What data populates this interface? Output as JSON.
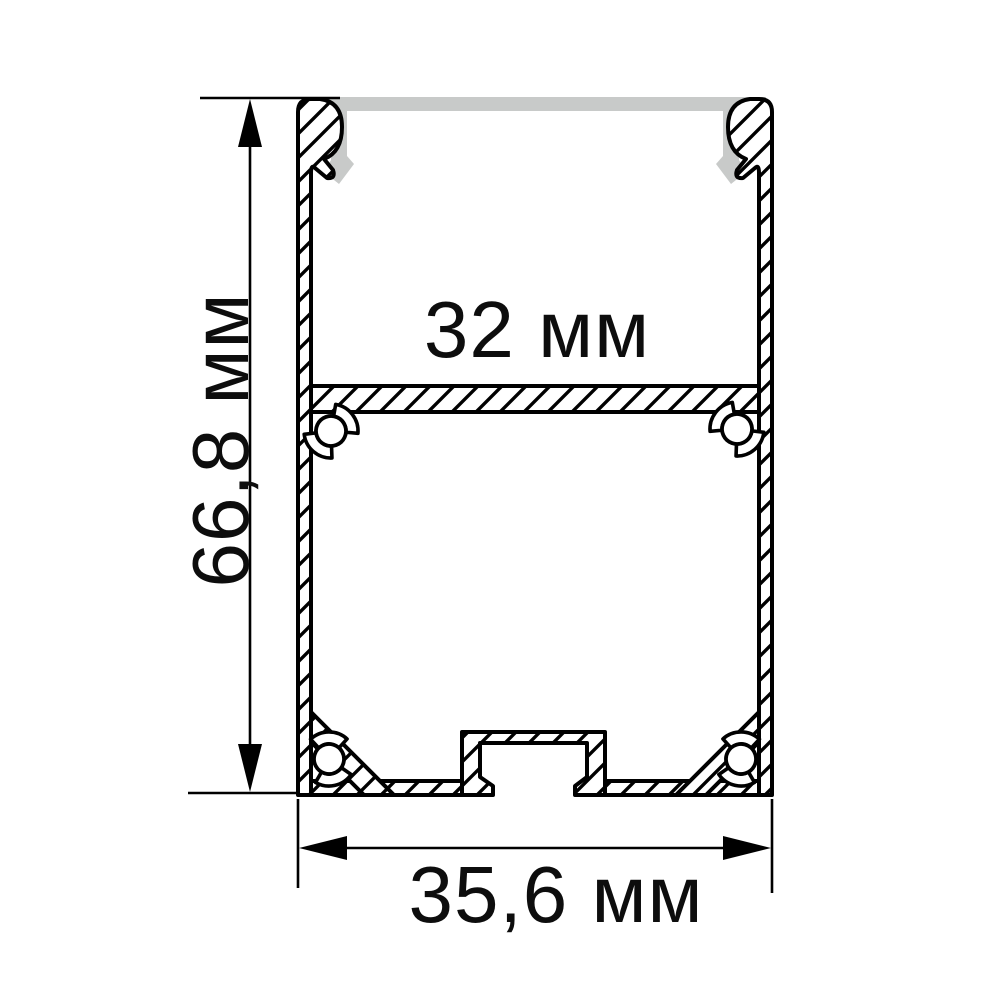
{
  "drawing": {
    "type": "technical-cross-section",
    "subject": "Aluminium LED profile with diffuser cover, cross-section with dimensions",
    "dimensions": {
      "height": {
        "label": "66,8 мм",
        "value_mm": 66.8,
        "orientation": "vertical"
      },
      "inner_width": {
        "label": "32 мм",
        "value_mm": 32.0,
        "orientation": "horizontal"
      },
      "outer_width": {
        "label": "35,6 мм",
        "value_mm": 35.6,
        "orientation": "horizontal"
      }
    },
    "colors": {
      "line": "#000000",
      "diffuser": "#c8cac9",
      "background": "#ffffff"
    }
  }
}
